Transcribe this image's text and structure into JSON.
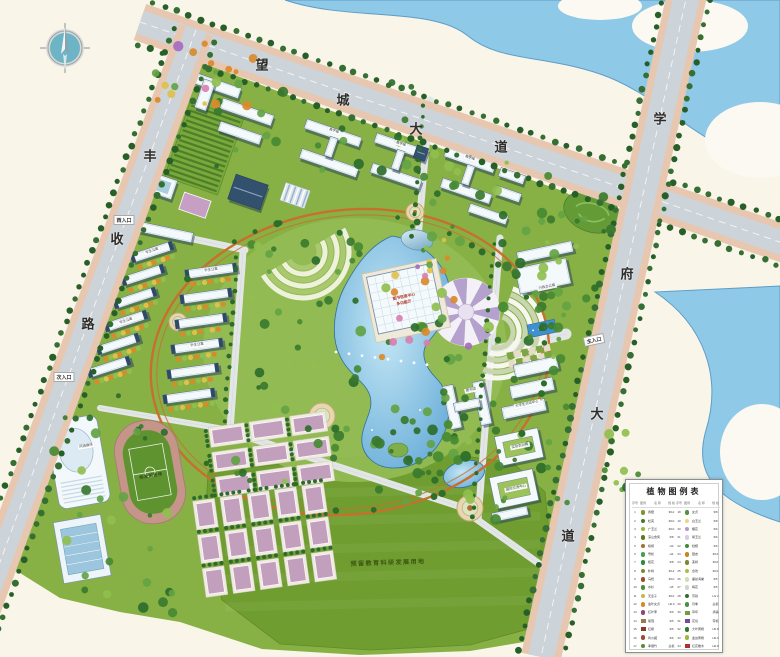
{
  "roads": {
    "north": "望城大道",
    "west": "丰收路",
    "east": "学府大道"
  },
  "entrances": {
    "west": "西入口",
    "secondary": "次入口",
    "main": "主入口"
  },
  "labels": {
    "center1": "图书信息中心",
    "center2": "多功能厅",
    "admin": "行政办公楼",
    "library": "图书馆",
    "activity": "大学生活动中心",
    "training": "实验实训楼",
    "exchange": "国际交流中心",
    "gym": "风雨操场",
    "teach": "教学楼",
    "dorm": "学生公寓",
    "track": "标准田径场",
    "reserved": "预留教育科研发展用地"
  },
  "legend": {
    "title": "植物图例表",
    "headers": [
      "序号",
      "图例",
      "名 称",
      "规 格"
    ],
    "rows": [
      {
        "no": "1",
        "name": "香樟",
        "spec": "Φ12",
        "color": "#7f9430",
        "shape": "dot"
      },
      {
        "no": "2",
        "name": "杜英",
        "spec": "Φ10",
        "color": "#3f7d2a",
        "shape": "dot"
      },
      {
        "no": "3",
        "name": "广玉兰",
        "spec": "Φ10",
        "color": "#9ab83a",
        "shape": "dot"
      },
      {
        "no": "4",
        "name": "深山含笑",
        "spec": "Φ8",
        "color": "#5c7a22",
        "shape": "dot"
      },
      {
        "no": "5",
        "name": "棕榈",
        "spec": "H3",
        "color": "#a0722c",
        "shape": "dot"
      },
      {
        "no": "6",
        "name": "雪松",
        "spec": "H4",
        "color": "#46a048",
        "shape": "dot"
      },
      {
        "no": "7",
        "name": "桂花",
        "spec": "Φ8",
        "color": "#2f8a3c",
        "shape": "dot"
      },
      {
        "no": "8",
        "name": "朴树",
        "spec": "Φ12",
        "color": "#6f8f2f",
        "shape": "dot"
      },
      {
        "no": "9",
        "name": "乌桕",
        "spec": "Φ10",
        "color": "#9a4f2a",
        "shape": "dot"
      },
      {
        "no": "10",
        "name": "水杉",
        "spec": "H5",
        "color": "#4f8f3a",
        "shape": "dot"
      },
      {
        "no": "11",
        "name": "无患子",
        "spec": "Φ10",
        "color": "#c8b84a",
        "shape": "dot"
      },
      {
        "no": "12",
        "name": "金叶女贞",
        "spec": "H0.6",
        "color": "#d88a2a",
        "shape": "dot"
      },
      {
        "no": "13",
        "name": "红叶李",
        "spec": "Φ6",
        "color": "#8a4a7a",
        "shape": "dot"
      },
      {
        "no": "14",
        "name": "紫薇",
        "spec": "Φ5",
        "color": "#9a7a4a",
        "shape": "sq"
      },
      {
        "no": "15",
        "name": "红枫",
        "spec": "Φ6",
        "color": "#8a3a2a",
        "shape": "sq"
      },
      {
        "no": "16",
        "name": "鸡爪槭",
        "spec": "Φ6",
        "color": "#a04a3a",
        "shape": "dot"
      },
      {
        "no": "17",
        "name": "孝顺竹",
        "spec": "丛植",
        "color": "#5a8a3a",
        "shape": "dot"
      },
      {
        "no": "18",
        "name": "女贞",
        "spec": "Φ8",
        "color": "#55933a",
        "shape": "dot"
      },
      {
        "no": "19",
        "name": "白玉兰",
        "spec": "Φ8",
        "color": "#e8d87a",
        "shape": "dot"
      },
      {
        "no": "20",
        "name": "樱花",
        "spec": "Φ6",
        "color": "#b89ac8",
        "shape": "dot"
      },
      {
        "no": "21",
        "name": "紫玉兰",
        "spec": "Φ6",
        "color": "#d8cae8",
        "shape": "dot"
      },
      {
        "no": "22",
        "name": "枇杷",
        "spec": "Φ6",
        "color": "#3f8a3a",
        "shape": "dot"
      },
      {
        "no": "23",
        "name": "银杏",
        "spec": "Φ12",
        "color": "#c8861e",
        "shape": "dot"
      },
      {
        "no": "24",
        "name": "栾树",
        "spec": "Φ10",
        "color": "#7a8a2e",
        "shape": "dot"
      },
      {
        "no": "25",
        "name": "合欢",
        "spec": "Φ10",
        "color": "#aabf3f",
        "shape": "dot"
      },
      {
        "no": "26",
        "name": "垂丝海棠",
        "spec": "Φ5",
        "color": "#cfe0b0",
        "shape": "dot"
      },
      {
        "no": "27",
        "name": "梅花",
        "spec": "Φ5",
        "color": "#d0d6cf",
        "shape": "dot"
      },
      {
        "no": "28",
        "name": "苏铁",
        "spec": "H1.2",
        "color": "#2f6e2f",
        "shape": "dot"
      },
      {
        "no": "29",
        "name": "月季",
        "spec": "丛植",
        "color": "#4a8f4a",
        "shape": "dot"
      },
      {
        "no": "30",
        "name": "草坪",
        "spec": "满铺",
        "color": "#6fa03f",
        "shape": "sq"
      },
      {
        "no": "31",
        "name": "花境",
        "spec": "带植",
        "color": "#7a4a9a",
        "shape": "sq"
      },
      {
        "no": "32",
        "name": "大叶黄杨",
        "spec": "H0.8",
        "color": "#2f7a33",
        "shape": "dot"
      },
      {
        "no": "33",
        "name": "金边黄杨",
        "spec": "H0.6",
        "color": "#9fb63a",
        "shape": "dot"
      },
      {
        "no": "34",
        "name": "红花檵木",
        "spec": "H0.8",
        "color": "#b03030",
        "shape": "sq"
      }
    ]
  },
  "colors": {
    "land": "#f9f5e8",
    "water": "#8ec9e8",
    "water_edge": "#5f9cc6",
    "campus_green": "#87b144",
    "park_green": "#95bd55",
    "field_green": "#6f9d2f",
    "road": "#ccd3d9",
    "sidewalk": "#e7c7b0",
    "ring_path": "#c96f2d",
    "lake_deep": "#63a9d6",
    "court": "#c2a0bd",
    "roof_navy": "#33516f",
    "building": "#f4f9fc"
  }
}
